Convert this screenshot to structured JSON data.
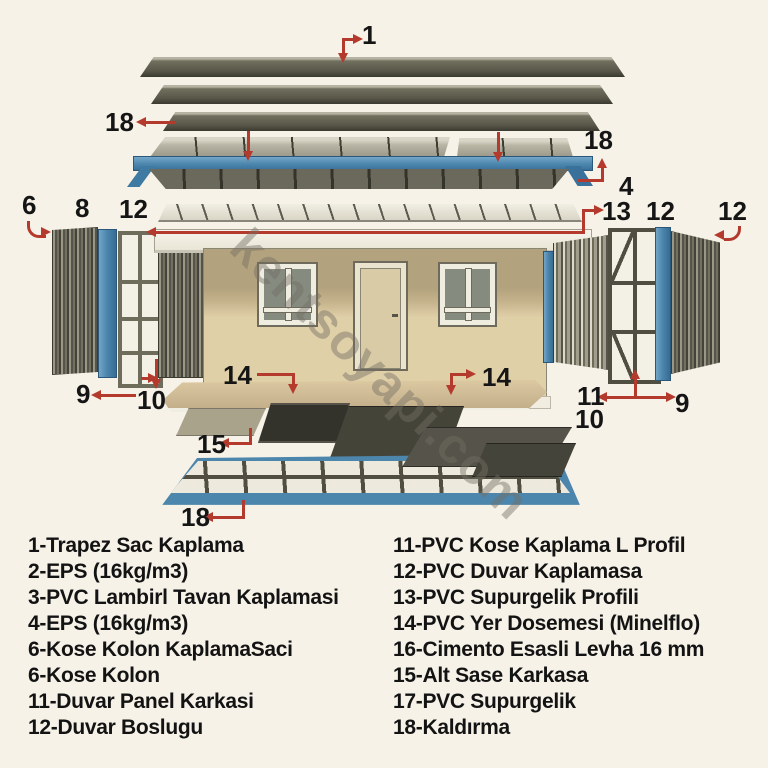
{
  "watermark": "kentsoyapi.com",
  "colors": {
    "background": "#f6f2e8",
    "callout_red": "#b43a2d",
    "steel_blue": "#4d86ad",
    "panel_olive": "#6b695b",
    "wall_beige": "#e0d0a8",
    "floor_tan": "#d0bc96"
  },
  "callouts": {
    "roof_sheet": "1",
    "lift_top_left": "18",
    "lift_top_right": "18",
    "roof_eps": "4",
    "corner_clad": "6",
    "corner_blue": "8",
    "wall_frame_left": "12",
    "ceiling_pvc": "13",
    "wall_blue_right": "12",
    "wall_far_right": "12",
    "left_9": "9",
    "left_10": "10",
    "floor_left": "14",
    "floor_right": "14",
    "right_11": "11",
    "right_10": "10",
    "right_9": "9",
    "subfloor": "15",
    "lift_bottom": "18"
  },
  "legend": {
    "left": [
      "1-Trapez Sac Kaplama",
      "2-EPS (16kg/m3)",
      "3-PVC Lambirl Tavan Kaplamasi",
      "4-EPS (16kg/m3)",
      "6-Kose Kolon KaplamaSaci",
      "6-Kose Kolon",
      "11-Duvar Panel Karkasi",
      "12-Duvar Boslugu"
    ],
    "right": [
      "11-PVC Kose Kaplama L Profil",
      "12-PVC Duvar Kaplamasa",
      "13-PVC Supurgelik Profili",
      "14-PVC Yer Dosemesi (Minelflo)",
      "16-Cimento Esasli Levha 16 mm",
      "15-Alt Sase Karkasa",
      "17-PVC Supurgelik",
      "18-Kaldırma"
    ]
  }
}
